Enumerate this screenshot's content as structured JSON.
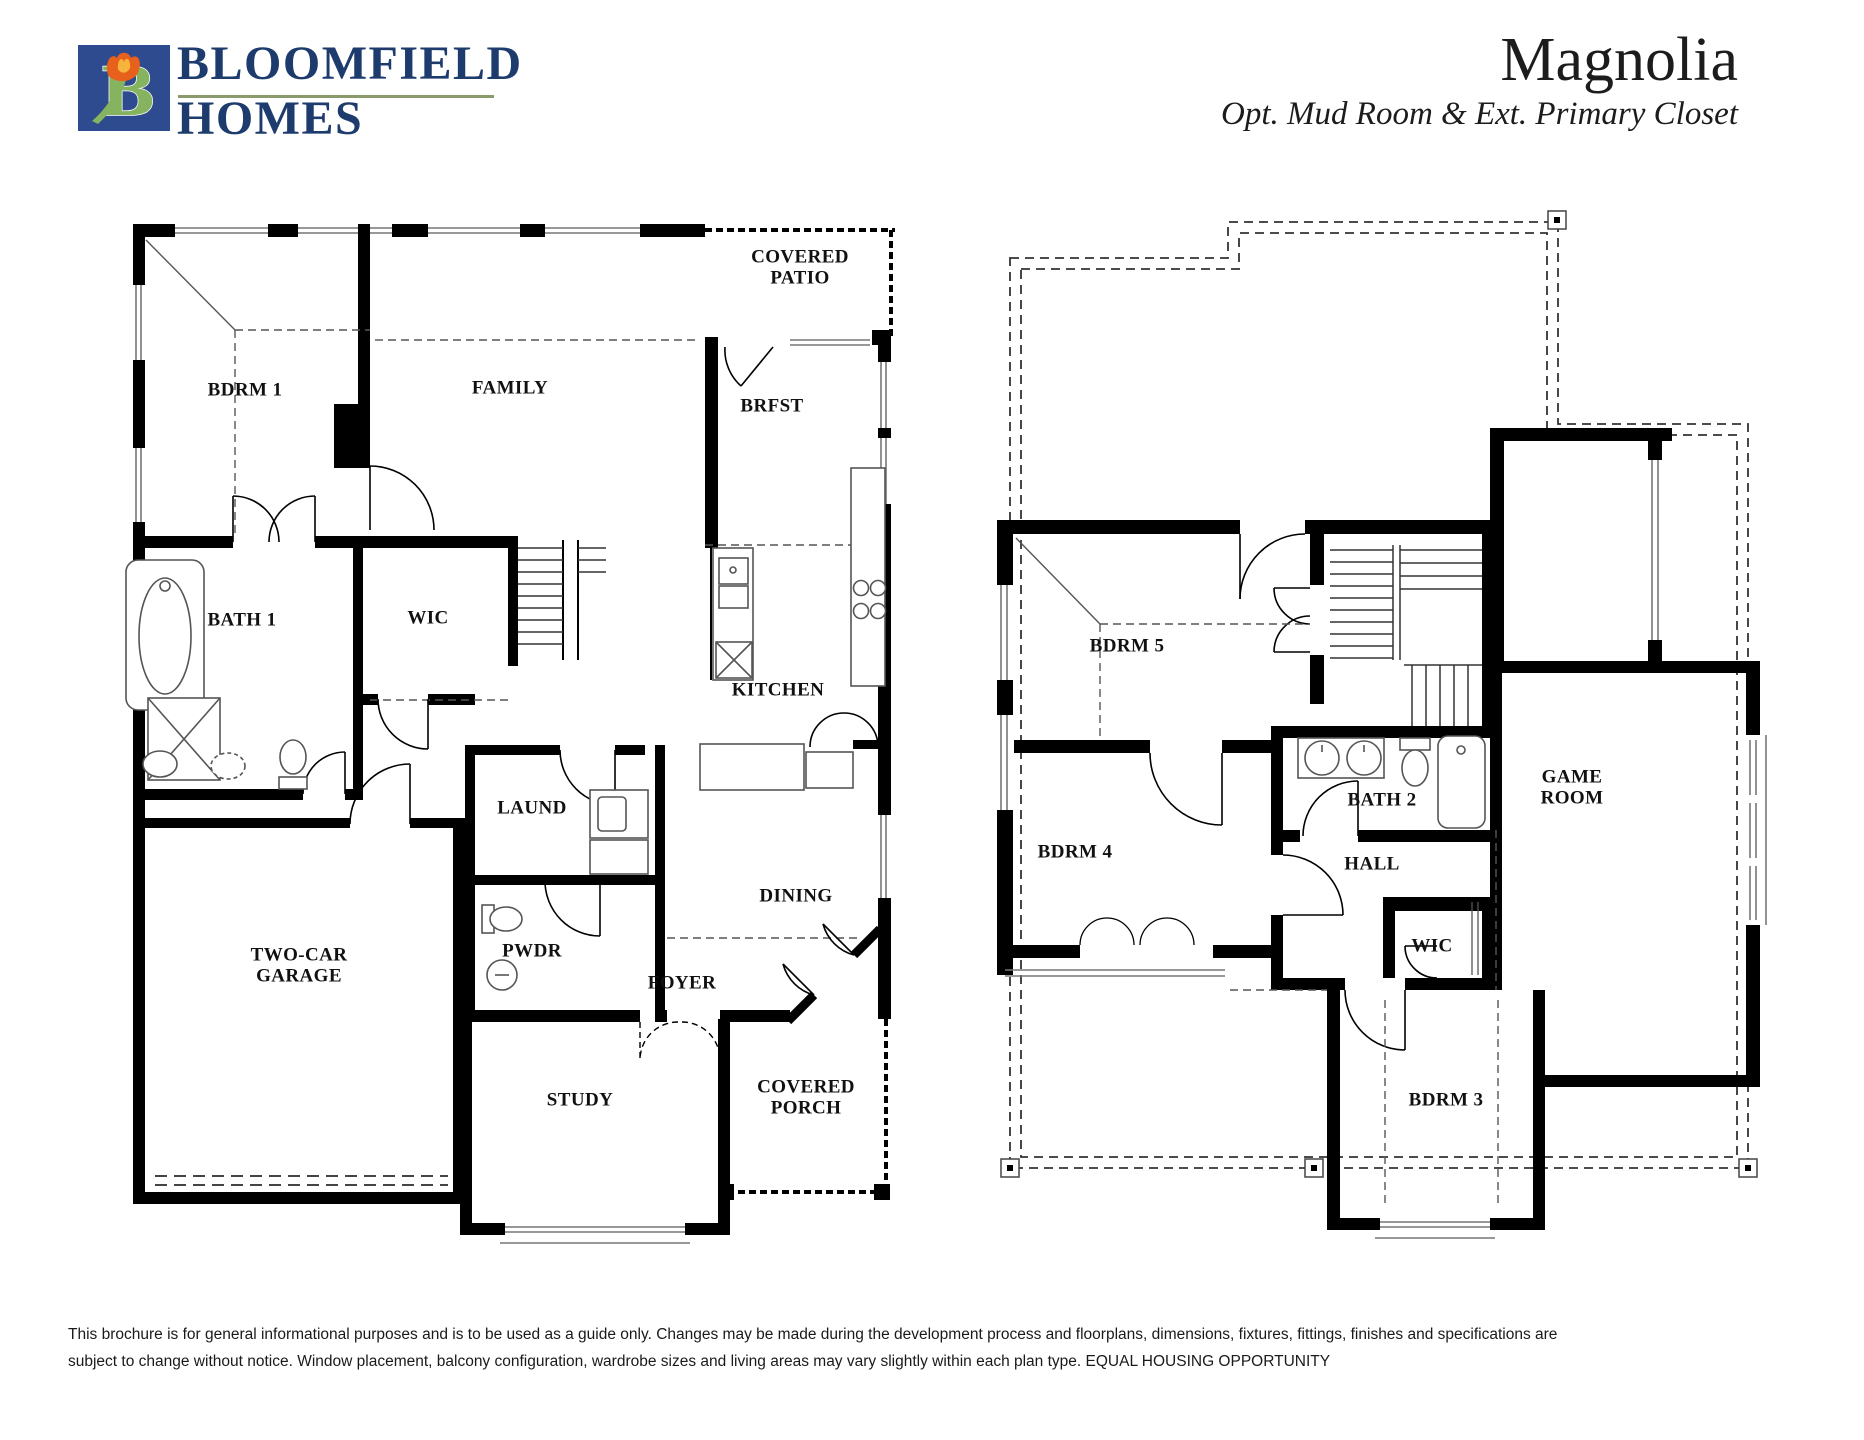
{
  "header": {
    "logo": {
      "line1": "BLOOMFIELD",
      "line2": "HOMES",
      "letter": "B",
      "square_color": "#2e4b8f",
      "b_color": "#85b35f",
      "tulip_color": "#e8611c",
      "tulip_inner_color": "#f6b43c",
      "underline_color": "#8a9a6a",
      "text_color": "#1d3b6d"
    },
    "title": "Magnolia",
    "subtitle": "Opt. Mud Room & Ext. Primary Closet"
  },
  "floor1": {
    "rooms": [
      {
        "id": "bdrm-1",
        "label": "BDRM 1"
      },
      {
        "id": "family",
        "label": "FAMILY"
      },
      {
        "id": "covered-patio",
        "label": "COVERED\nPATIO"
      },
      {
        "id": "brfst",
        "label": "BRFST"
      },
      {
        "id": "bath-1",
        "label": "BATH 1"
      },
      {
        "id": "wic",
        "label": "WIC"
      },
      {
        "id": "kitchen",
        "label": "KITCHEN"
      },
      {
        "id": "laund",
        "label": "LAUND"
      },
      {
        "id": "dining",
        "label": "DINING"
      },
      {
        "id": "pwdr",
        "label": "PWDR"
      },
      {
        "id": "two-car-garage",
        "label": "TWO-CAR\nGARAGE"
      },
      {
        "id": "foyer",
        "label": "FOYER"
      },
      {
        "id": "study",
        "label": "STUDY"
      },
      {
        "id": "covered-porch",
        "label": "COVERED\nPORCH"
      }
    ]
  },
  "floor2": {
    "rooms": [
      {
        "id": "bdrm-5",
        "label": "BDRM 5"
      },
      {
        "id": "bdrm-4",
        "label": "BDRM 4"
      },
      {
        "id": "bath-2",
        "label": "BATH 2"
      },
      {
        "id": "hall",
        "label": "HALL"
      },
      {
        "id": "game-room",
        "label": "GAME\nROOM"
      },
      {
        "id": "wic",
        "label": "WIC"
      },
      {
        "id": "bdrm-3",
        "label": "BDRM 3"
      }
    ]
  },
  "footer": {
    "line1": "This brochure is for general informational purposes and is to be used as a guide only. Changes may be made during the development process and floorplans, dimensions, fixtures, fittings, finishes and specifications are",
    "line2": "subject to change without notice. Window placement, balcony configuration, wardrobe sizes and living areas may vary slightly within each plan type.  EQUAL HOUSING OPPORTUNITY"
  }
}
